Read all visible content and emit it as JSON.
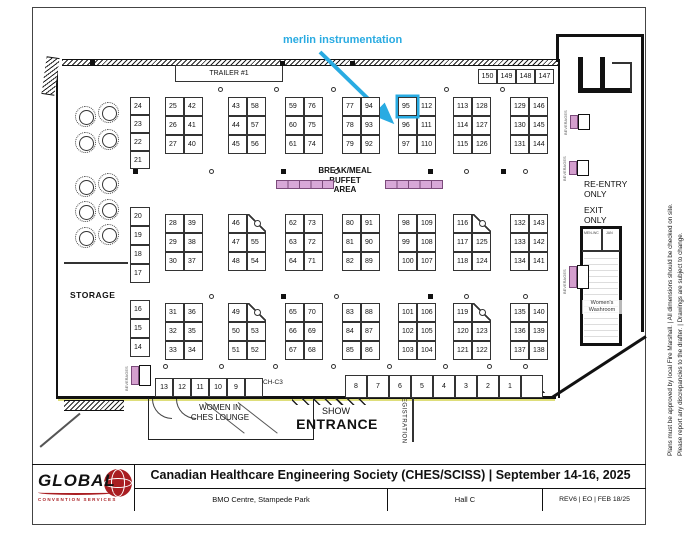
{
  "annotation": {
    "label": "merlin instrumentation",
    "color": "#29abe2",
    "target_booth": "95"
  },
  "labels": {
    "trailer": "TRAILER #1",
    "storage": "STORAGE",
    "buffet_line1": "BREAK/MEAL",
    "buffet_line2": "BUFFET",
    "buffet_line3": "AREA",
    "re_entry_l1": "RE-ENTRY",
    "re_entry_l2": "ONLY",
    "exit_l1": "EXIT",
    "exit_l2": "ONLY",
    "womens_washroom_l1": "Women's",
    "womens_washroom_l2": "Washroom",
    "washroom_room_1": "MEN-WC",
    "washroom_room_2": "JAN",
    "women_ches_l1": "WOMEN IN",
    "women_ches_l2": "CHES LOUNGE",
    "show": "SHOW",
    "entrance": "ENTRANCE",
    "registration": "REGISTRATION",
    "ch_c3": "CH-C3",
    "beverages": "BEVERAGES"
  },
  "booth_blocks": [
    {
      "x": 165,
      "y": 97,
      "cut": false,
      "rows": [
        [
          "25",
          "42"
        ],
        [
          "26",
          "41"
        ],
        [
          "27",
          "40"
        ]
      ]
    },
    {
      "x": 228,
      "y": 97,
      "cut": false,
      "rows": [
        [
          "43",
          "58"
        ],
        [
          "44",
          "57"
        ],
        [
          "45",
          "56"
        ]
      ]
    },
    {
      "x": 285,
      "y": 97,
      "cut": false,
      "rows": [
        [
          "59",
          "76"
        ],
        [
          "60",
          "75"
        ],
        [
          "61",
          "74"
        ]
      ]
    },
    {
      "x": 342,
      "y": 97,
      "cut": false,
      "rows": [
        [
          "77",
          "94"
        ],
        [
          "78",
          "93"
        ],
        [
          "79",
          "92"
        ]
      ]
    },
    {
      "x": 398,
      "y": 97,
      "cut": false,
      "rows": [
        [
          "95",
          "112"
        ],
        [
          "96",
          "111"
        ],
        [
          "97",
          "110"
        ]
      ]
    },
    {
      "x": 453,
      "y": 97,
      "cut": false,
      "rows": [
        [
          "113",
          "128"
        ],
        [
          "114",
          "127"
        ],
        [
          "115",
          "126"
        ]
      ]
    },
    {
      "x": 510,
      "y": 97,
      "cut": false,
      "rows": [
        [
          "129",
          "146"
        ],
        [
          "130",
          "145"
        ],
        [
          "131",
          "144"
        ]
      ]
    },
    {
      "x": 165,
      "y": 214,
      "cut": false,
      "rows": [
        [
          "28",
          "39"
        ],
        [
          "29",
          "38"
        ],
        [
          "30",
          "37"
        ]
      ]
    },
    {
      "x": 228,
      "y": 214,
      "cut": true,
      "rows": [
        [
          "46",
          ""
        ],
        [
          "47",
          "55"
        ],
        [
          "48",
          "54"
        ]
      ]
    },
    {
      "x": 285,
      "y": 214,
      "cut": false,
      "rows": [
        [
          "62",
          "73"
        ],
        [
          "63",
          "72"
        ],
        [
          "64",
          "71"
        ]
      ]
    },
    {
      "x": 342,
      "y": 214,
      "cut": false,
      "rows": [
        [
          "80",
          "91"
        ],
        [
          "81",
          "90"
        ],
        [
          "82",
          "89"
        ]
      ]
    },
    {
      "x": 398,
      "y": 214,
      "cut": false,
      "rows": [
        [
          "98",
          "109"
        ],
        [
          "99",
          "108"
        ],
        [
          "100",
          "107"
        ]
      ]
    },
    {
      "x": 453,
      "y": 214,
      "cut": true,
      "rows": [
        [
          "116",
          ""
        ],
        [
          "117",
          "125"
        ],
        [
          "118",
          "124"
        ]
      ]
    },
    {
      "x": 510,
      "y": 214,
      "cut": false,
      "rows": [
        [
          "132",
          "143"
        ],
        [
          "133",
          "142"
        ],
        [
          "134",
          "141"
        ]
      ]
    },
    {
      "x": 165,
      "y": 303,
      "cut": false,
      "rows": [
        [
          "31",
          "36"
        ],
        [
          "32",
          "35"
        ],
        [
          "33",
          "34"
        ]
      ]
    },
    {
      "x": 228,
      "y": 303,
      "cut": true,
      "rows": [
        [
          "49",
          ""
        ],
        [
          "50",
          "53"
        ],
        [
          "51",
          "52"
        ]
      ]
    },
    {
      "x": 285,
      "y": 303,
      "cut": false,
      "rows": [
        [
          "65",
          "70"
        ],
        [
          "66",
          "69"
        ],
        [
          "67",
          "68"
        ]
      ]
    },
    {
      "x": 342,
      "y": 303,
      "cut": false,
      "rows": [
        [
          "83",
          "88"
        ],
        [
          "84",
          "87"
        ],
        [
          "85",
          "86"
        ]
      ]
    },
    {
      "x": 398,
      "y": 303,
      "cut": false,
      "rows": [
        [
          "101",
          "106"
        ],
        [
          "102",
          "105"
        ],
        [
          "103",
          "104"
        ]
      ]
    },
    {
      "x": 453,
      "y": 303,
      "cut": true,
      "rows": [
        [
          "119",
          ""
        ],
        [
          "120",
          "123"
        ],
        [
          "121",
          "122"
        ]
      ]
    },
    {
      "x": 510,
      "y": 303,
      "cut": false,
      "rows": [
        [
          "135",
          "140"
        ],
        [
          "136",
          "139"
        ],
        [
          "137",
          "138"
        ]
      ]
    }
  ],
  "strips": [
    {
      "x": 130,
      "y": 97,
      "cell_h": 18,
      "cells": [
        "24",
        "23",
        "22",
        "21"
      ]
    },
    {
      "x": 130,
      "y": 207,
      "cell_h": 19,
      "cells": [
        "20",
        "19",
        "18",
        "17"
      ]
    },
    {
      "x": 130,
      "y": 300,
      "cell_h": 19,
      "cells": [
        "16",
        "15",
        "14"
      ]
    }
  ],
  "booth_rows": [
    {
      "x": 478,
      "y": 69,
      "cell_w": 19,
      "cell_h": 15,
      "cells": [
        "150",
        "149",
        "148",
        "147"
      ]
    },
    {
      "x": 155,
      "y": 378,
      "cell_w": 18,
      "cell_h": 19,
      "cells": [
        "13",
        "12",
        "11",
        "10",
        "9",
        ""
      ]
    },
    {
      "x": 345,
      "y": 375,
      "cell_w": 22,
      "cell_h": 23,
      "cells": [
        "8",
        "7",
        "6",
        "5",
        "4",
        "3",
        "2",
        "1",
        ""
      ]
    }
  ],
  "pillars": {
    "squares": [
      [
        90,
        60
      ],
      [
        280,
        61
      ],
      [
        350,
        61
      ],
      [
        133,
        169
      ],
      [
        281,
        169
      ],
      [
        428,
        169
      ],
      [
        501,
        169
      ],
      [
        281,
        294
      ],
      [
        428,
        294
      ]
    ],
    "circles": [
      [
        218,
        87
      ],
      [
        274,
        87
      ],
      [
        331,
        87
      ],
      [
        444,
        87
      ],
      [
        500,
        87
      ],
      [
        209,
        169
      ],
      [
        334,
        169
      ],
      [
        464,
        169
      ],
      [
        523,
        169
      ],
      [
        209,
        294
      ],
      [
        334,
        294
      ],
      [
        464,
        294
      ],
      [
        523,
        294
      ],
      [
        163,
        364
      ],
      [
        219,
        364
      ],
      [
        273,
        364
      ],
      [
        331,
        364
      ],
      [
        387,
        364
      ],
      [
        443,
        364
      ],
      [
        487,
        364
      ],
      [
        523,
        364
      ]
    ]
  },
  "round_tables": [
    [
      75,
      106
    ],
    [
      98,
      102
    ],
    [
      75,
      132
    ],
    [
      98,
      129
    ],
    [
      75,
      176
    ],
    [
      98,
      173
    ],
    [
      75,
      201
    ],
    [
      98,
      199
    ],
    [
      75,
      227
    ],
    [
      98,
      224
    ]
  ],
  "beverage_stations": [
    {
      "x": 570,
      "y": 115,
      "w": 8,
      "h": 14,
      "label": true
    },
    {
      "x": 569,
      "y": 161,
      "w": 8,
      "h": 14,
      "label": true
    },
    {
      "x": 569,
      "y": 266,
      "w": 8,
      "h": 22,
      "label": true
    },
    {
      "x": 131,
      "y": 366,
      "w": 8,
      "h": 19,
      "label": true
    }
  ],
  "footer": {
    "title": "Canadian Healthcare Engineering Society (CHES/SCISS) | September 14-16, 2025",
    "venue": "BMO Centre, Stampede Park",
    "hall": "Hall C",
    "revision": "REV6 | EO | FEB 18/25",
    "logo_name": "GLOBAL",
    "logo_sub": "CONVENTION SERVICES"
  },
  "margin_notes": [
    "Plans must be approved by local Fire Marshall. | All dimensions should be checked on site.",
    "Please report any discrepancies to the drafter. | Drawings are subject to change."
  ],
  "colors": {
    "annotation": "#29abe2",
    "buffet": "#d8a8d8",
    "wall": "#111111"
  }
}
